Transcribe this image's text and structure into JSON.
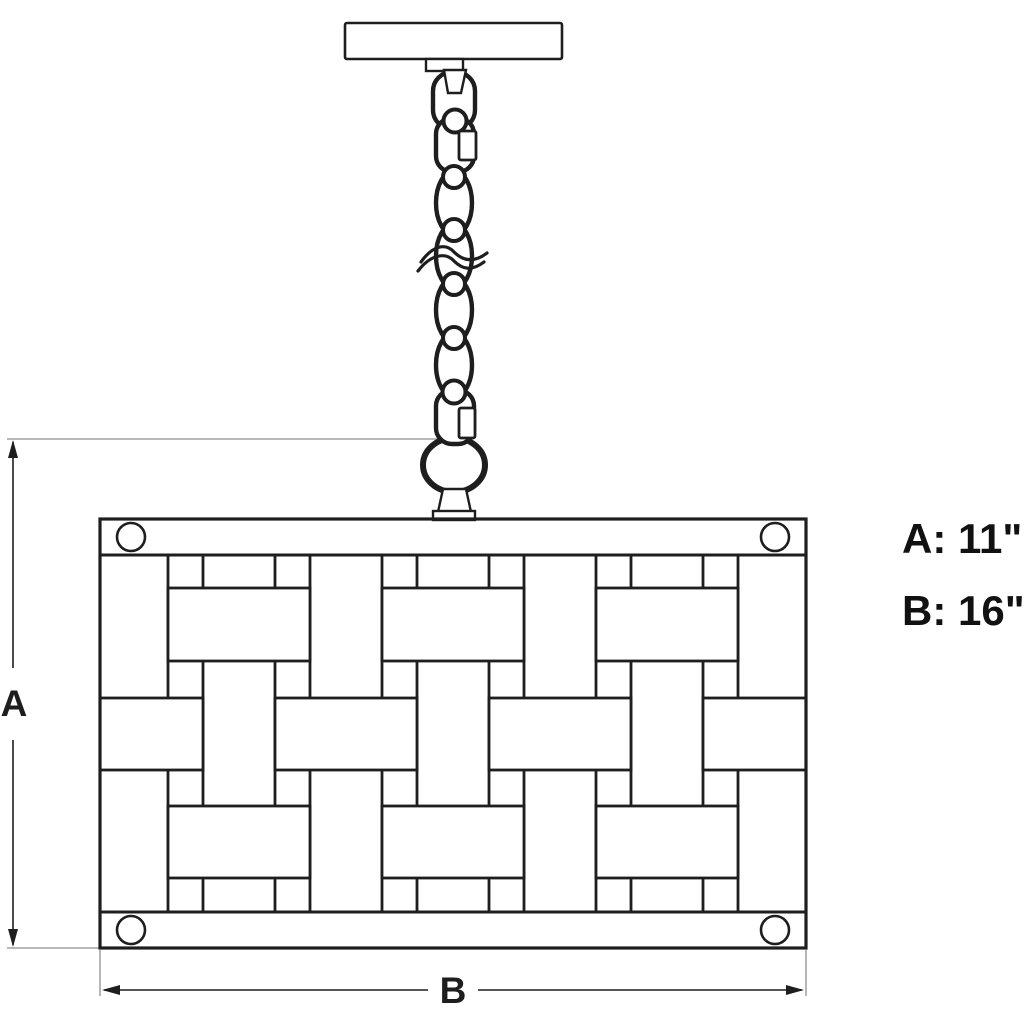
{
  "labels": {
    "dim_a": "A",
    "dim_b": "B",
    "spec_a": "A: 11\"",
    "spec_b": "B: 16\""
  },
  "colors": {
    "line": "#1e1e1e",
    "extension_line": "#8f8f8f",
    "background": "#ffffff"
  }
}
